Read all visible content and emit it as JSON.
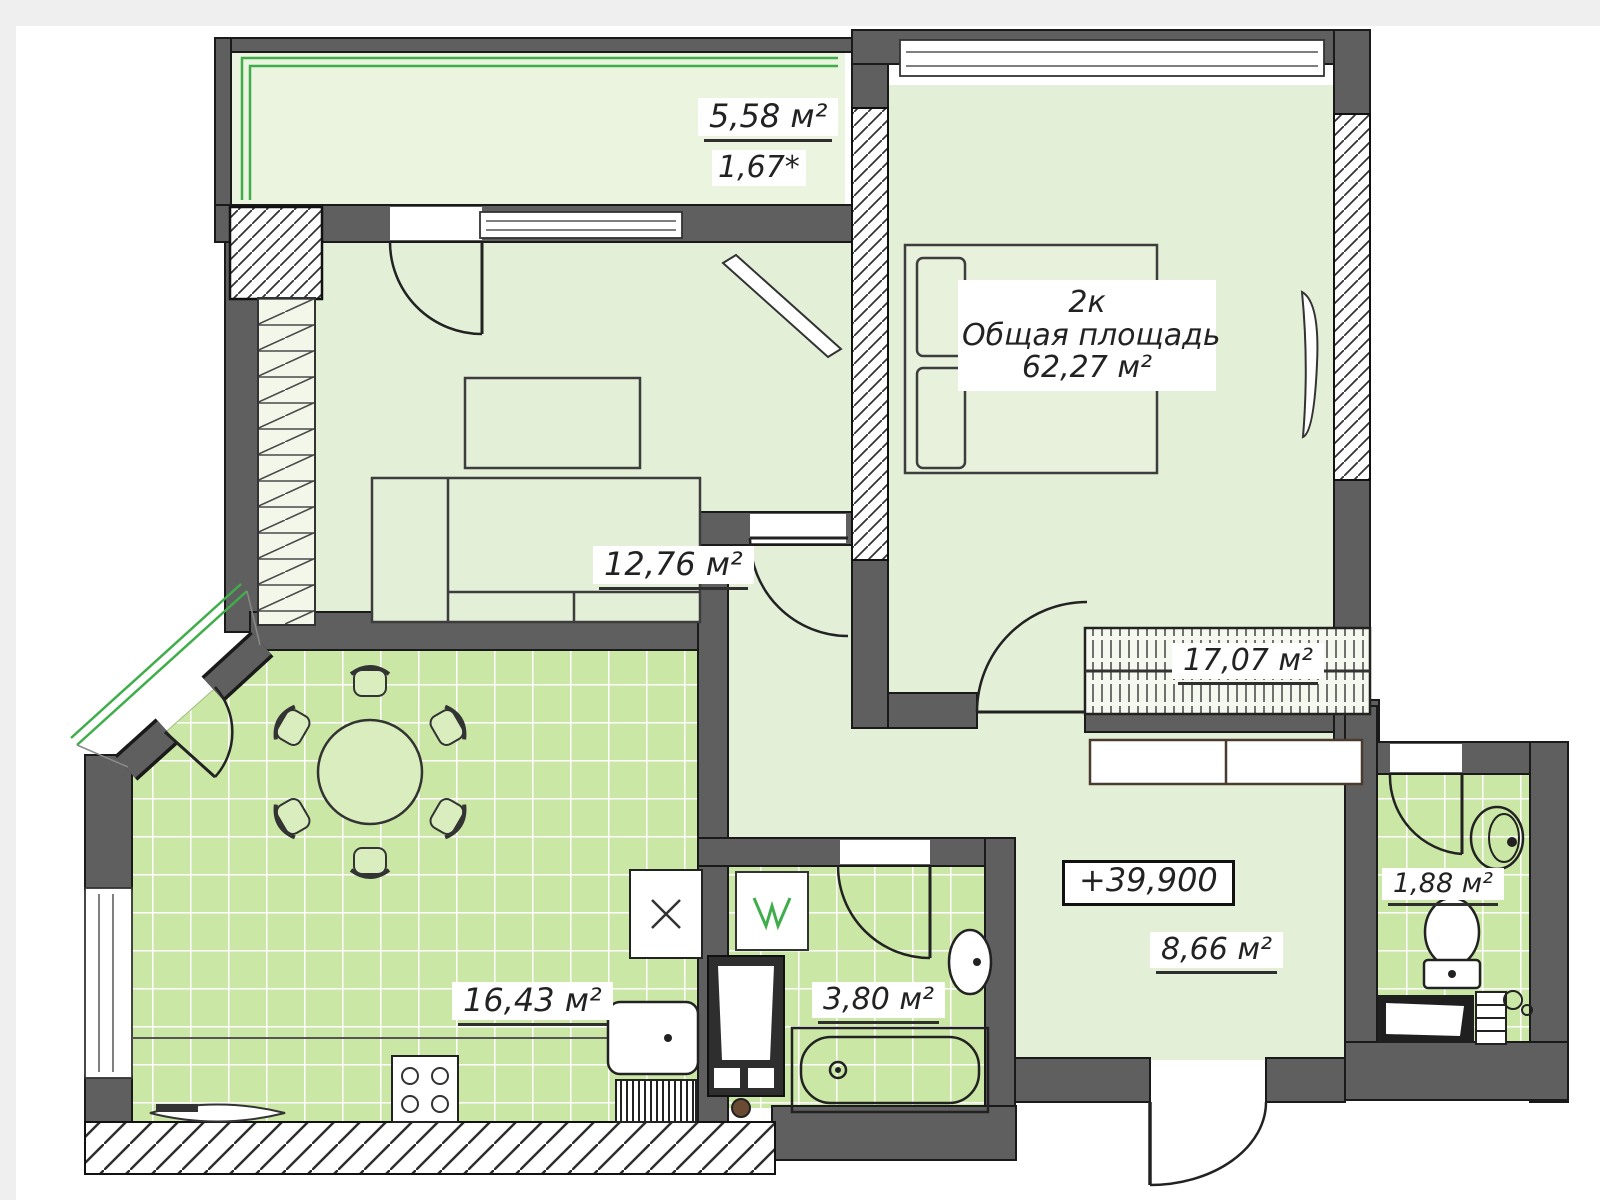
{
  "document": {
    "type": "floor-plan",
    "kind": "apartment plan drawing"
  },
  "apartment": {
    "name": "2к",
    "total_area_label": "Общая площадь",
    "total_area": "62,27 м²",
    "elevation": "+39,900"
  },
  "rooms": [
    {
      "id": "balcony",
      "area": "5,58 м²",
      "coefficient": "1,67*"
    },
    {
      "id": "living-room",
      "area": "12,76 м²"
    },
    {
      "id": "bedroom",
      "area": "17,07 м²"
    },
    {
      "id": "kitchen",
      "area": "16,43 м²"
    },
    {
      "id": "bathroom",
      "area": "3,80 м²"
    },
    {
      "id": "hallway",
      "area": "8,66 м²"
    },
    {
      "id": "wc",
      "area": "1,88 м²"
    }
  ],
  "colors": {
    "wall": "#5f5f5f",
    "wall_outline": "#1a1a1a",
    "room_fill": "#e4efd8",
    "balcony_fill": "#eaf4df",
    "tile_fill": "#cbe7a6",
    "tile_grid": "#ffffff",
    "glazing_green": "#3fae4a",
    "fixture_outline": "#333333",
    "label_text": "#222222"
  }
}
